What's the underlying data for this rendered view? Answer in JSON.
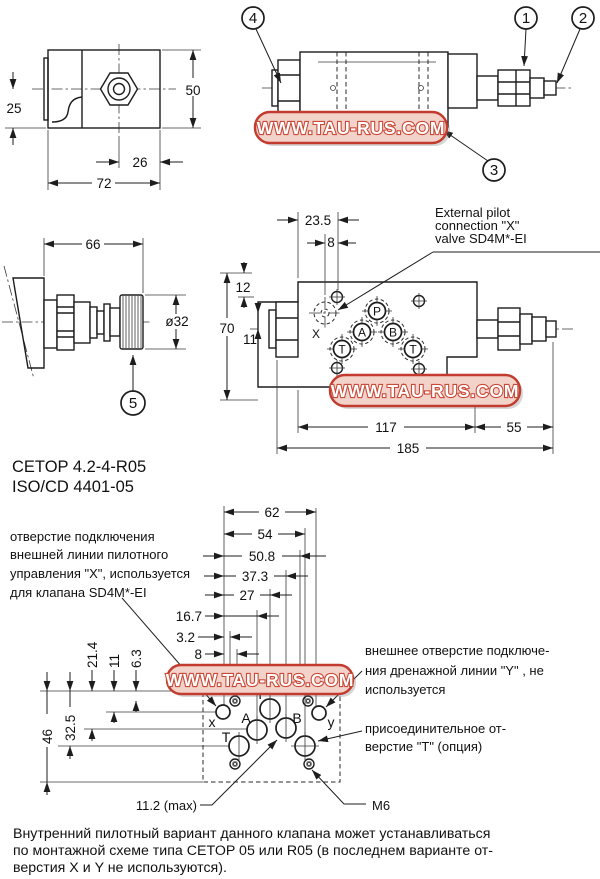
{
  "watermark": {
    "text": "WWW.TAU-RUS.COM",
    "border_color": "#c23b2e",
    "fill_color": "#f3d2ca",
    "text_color": "#ffffff"
  },
  "front_view": {
    "dim_25": "25",
    "dim_50": "50",
    "dim_26": "26",
    "dim_72": "72"
  },
  "side_view": {
    "callout_1": "1",
    "callout_2": "2",
    "callout_3": "3",
    "callout_4": "4"
  },
  "knob_view": {
    "dim_66": "66",
    "dim_d32": "ø32",
    "callout_5": "5"
  },
  "top_view": {
    "dim_23_5": "23.5",
    "dim_8": "8",
    "dim_12": "12",
    "dim_70": "70",
    "dim_11": "11",
    "dim_117": "117",
    "dim_55": "55",
    "dim_185": "185",
    "port_x": "X",
    "port_p": "P",
    "port_a": "A",
    "port_b": "B",
    "port_t1": "T",
    "port_t2": "T",
    "annotation": {
      "line1": "External pilot",
      "line2": "connection \"X\"",
      "line3": "valve SD4M*-EI"
    }
  },
  "standards": {
    "line1": "CETOP 4.2-4-R05",
    "line2": "ISO/CD 4401-05"
  },
  "pattern": {
    "dims_h": {
      "d62": "62",
      "d54": "54",
      "d50_8": "50.8",
      "d37_3": "37.3",
      "d27": "27",
      "d16_7": "16.7",
      "d3_2": "3.2",
      "d8": "8"
    },
    "dims_v": {
      "d21_4": "21.4",
      "d11": "11",
      "d6_3": "6.3",
      "d46": "46",
      "d32_5": "32.5"
    },
    "ports": {
      "x": "x",
      "a": "A",
      "p": "P",
      "b": "B",
      "y": "y",
      "t": "T"
    },
    "label_11_2": "11.2 (max)",
    "label_m6": "M6",
    "note_x": {
      "line1": "отверстие подключения",
      "line2": "внешней линии пилотного",
      "line3": "управления \"X\", используется",
      "line4": "для клапана SD4M*-EI"
    },
    "note_y": {
      "line1": "внешнее отверстие подключе-",
      "line2": "ния дренажной линии \"Y\" , не",
      "line3": "используется"
    },
    "note_t": {
      "line1": "присоединительное от-",
      "line2": "верстие \"T\" (опция)"
    }
  },
  "footer": {
    "line1": "Внутренний пилотный вариант данного клапана может устанавливаться",
    "line2": "по монтажной схеме типа CETOP 05 или R05 (в последнем варианте от-",
    "line3": "верстия X и Y не используются)."
  }
}
